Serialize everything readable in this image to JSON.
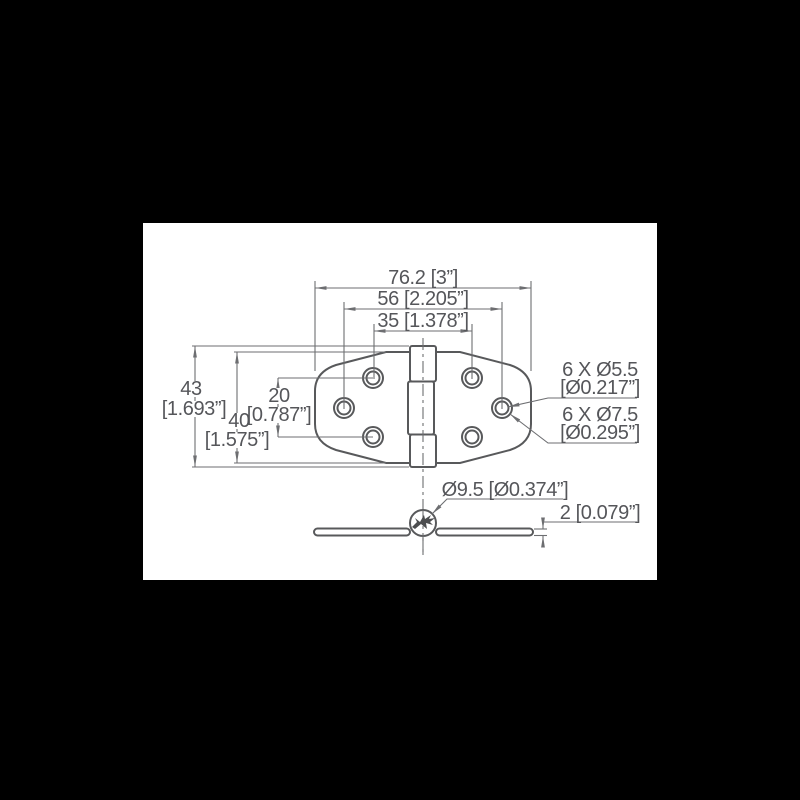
{
  "colors": {
    "page-bg": "#000000",
    "canvas-bg": "#ffffff",
    "object-line": "#58595b",
    "dim-line": "#6d6e71",
    "text-color": "#55565a",
    "blob-fill": "#4c4d4f"
  },
  "dims": {
    "width_overall": "76.2 [3”]",
    "width_holes_mid": "56 [2.205”]",
    "width_holes_top": "35 [1.378”]",
    "height_overall_mm": "43",
    "height_overall_in": "[1.693”]",
    "height_leaf_mm": "40",
    "height_leaf_in": "[1.575”]",
    "hole_rows_mm": "20",
    "hole_rows_in": "[0.787”]",
    "hole_small_qty": "6 X Ø5.5",
    "hole_small_in": "[Ø0.217”]",
    "hole_large_qty": "6 X Ø7.5",
    "hole_large_in": "[Ø0.295”]",
    "barrel_dia": "Ø9.5 [Ø0.374”]",
    "leaf_thickness": "2 [0.079”]"
  }
}
